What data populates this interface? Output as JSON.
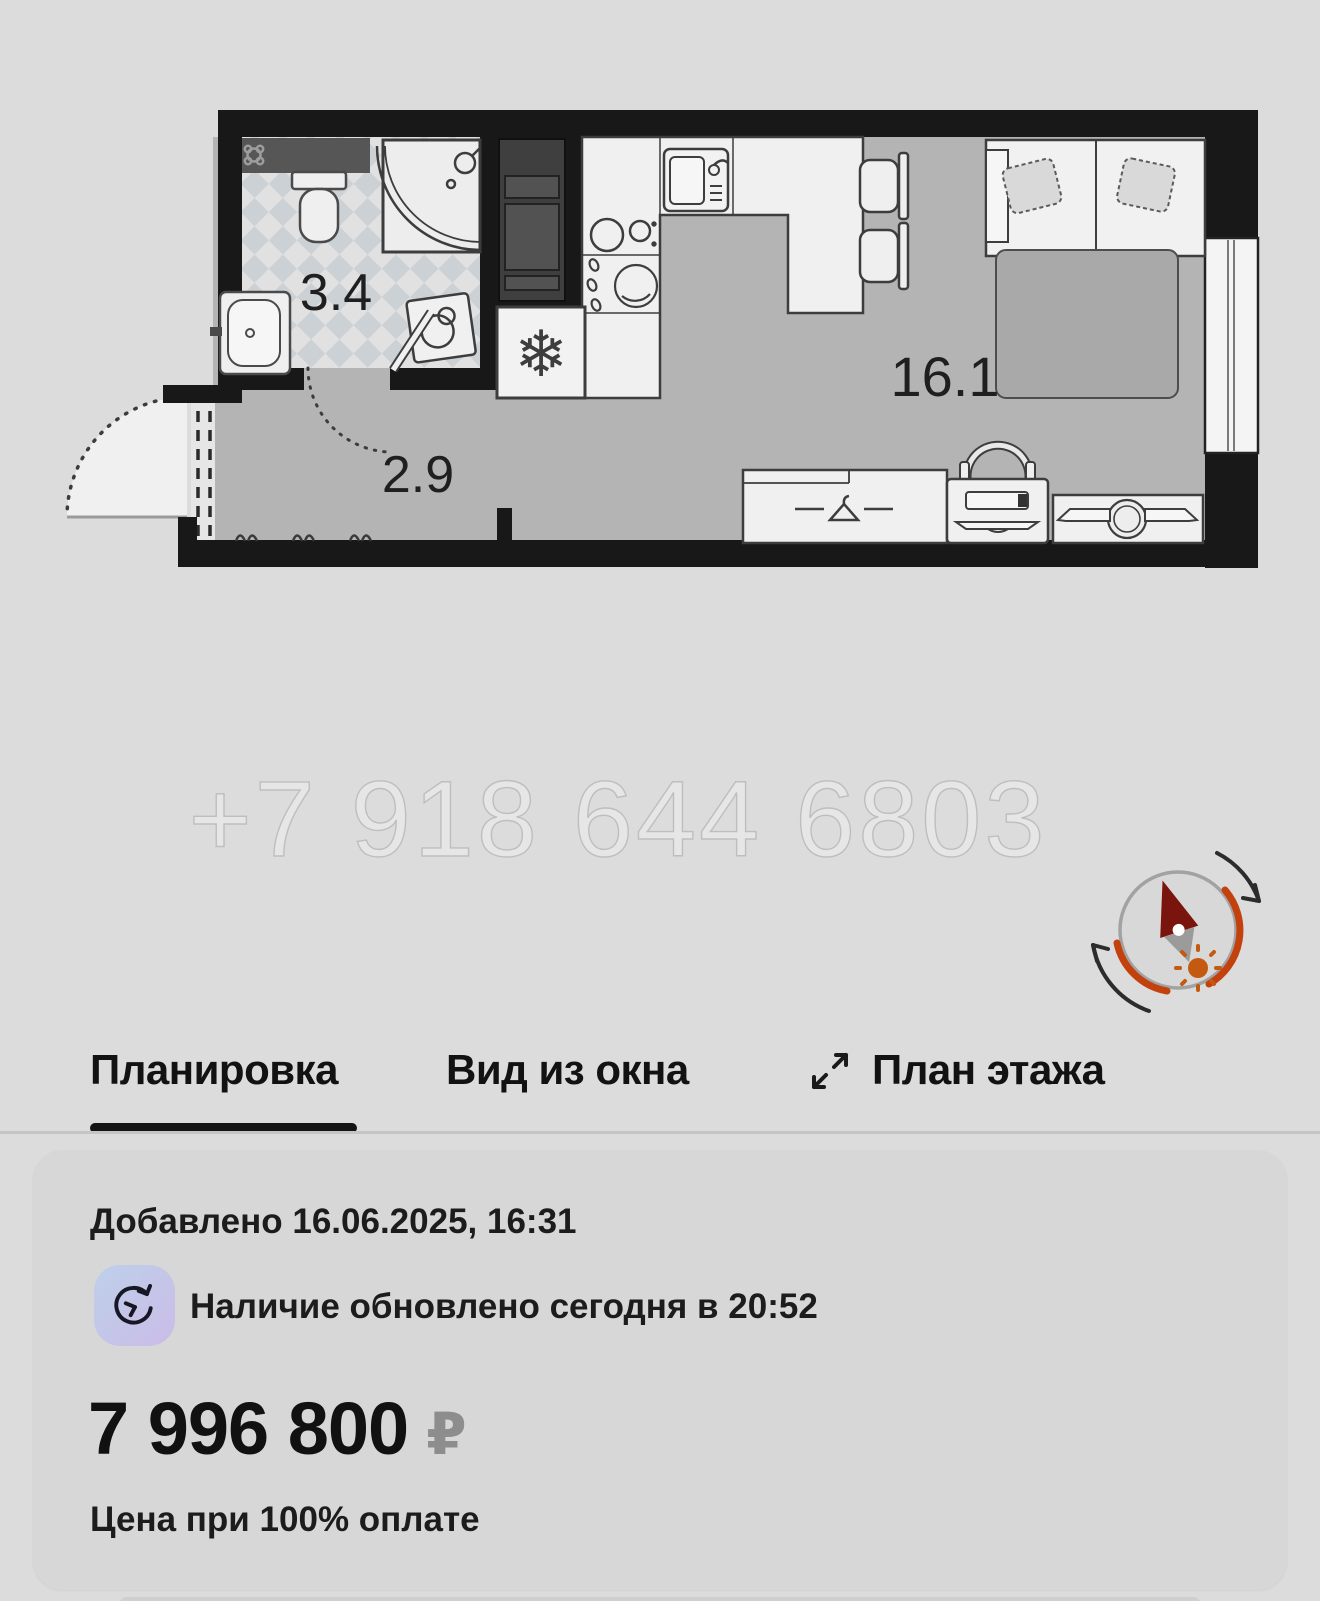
{
  "plan": {
    "watermark": "+7 918 644 6803",
    "rooms": [
      {
        "id": "bathroom",
        "area": "3.4"
      },
      {
        "id": "hallway",
        "area": "2.9"
      },
      {
        "id": "living-room",
        "area": "16.1"
      }
    ]
  },
  "tabs": [
    {
      "label": "Планировка",
      "active": true
    },
    {
      "label": "Вид из окна",
      "active": false
    },
    {
      "label": "План этажа",
      "active": false
    }
  ],
  "card": {
    "added": "Добавлено 16.06.2025, 16:31",
    "availability": "Наличие обновлено сегодня в 20:52",
    "price": "7 996 800",
    "currency": "₽",
    "price_note": "Цена при 100% оплате"
  },
  "icons": {
    "expand": "expand-diagonal-arrows-icon",
    "availability": "clock-history-icon",
    "compass": "sun-compass-icon",
    "snowflake": "❄"
  },
  "colors": {
    "page_bg": "#dcdcdc",
    "card_bg": "#d7d7d7",
    "tab_active_underline": "#141414",
    "compass_orange": "#c2410c",
    "needle_red": "#7a150d",
    "price_currency": "#8d8d8d",
    "icon_gradient_start": "#bdd0ea",
    "icon_gradient_end": "#cbbce7"
  }
}
